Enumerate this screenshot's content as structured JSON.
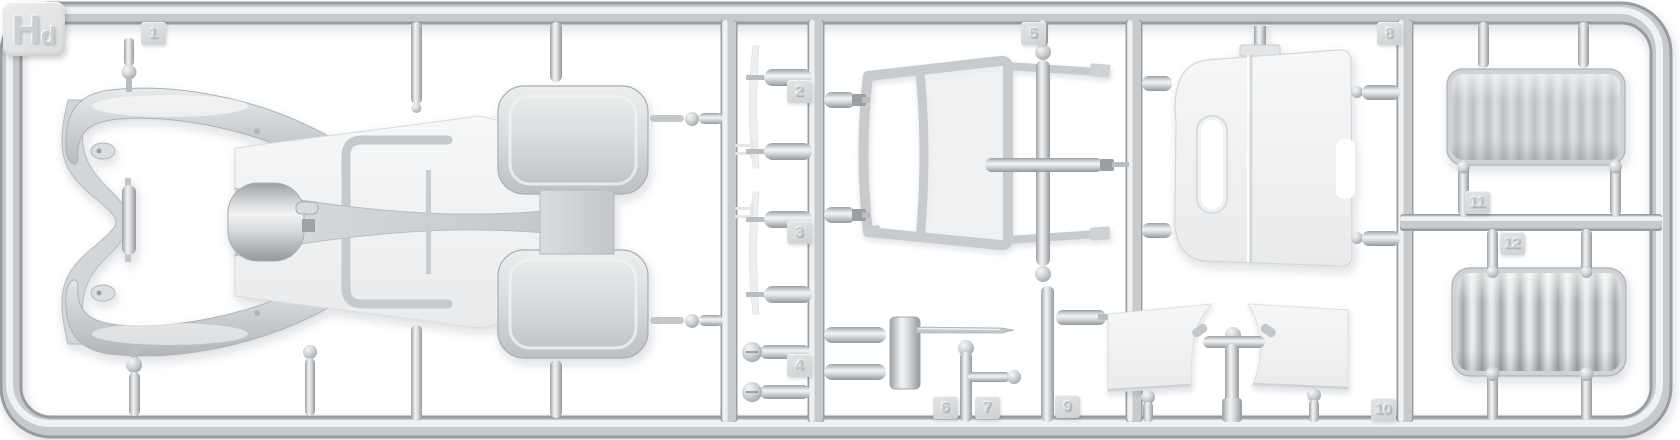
{
  "scene": {
    "subject": "top-view photo of a light-gray injection-molded plastic model kit sprue (runner frame) holding car body parts, windshield frame, roof panel, trim strips, levers and two pleated seat cushions",
    "sprue_label": {
      "full": "Hd",
      "main": "H",
      "sub": "d"
    },
    "part_tags": [
      {
        "label": "1"
      },
      {
        "label": "2"
      },
      {
        "label": "3"
      },
      {
        "label": "4"
      },
      {
        "label": "5"
      },
      {
        "label": "6"
      },
      {
        "label": "7"
      },
      {
        "label": "8"
      },
      {
        "label": "9"
      },
      {
        "label": "10"
      },
      {
        "label": "11"
      },
      {
        "label": "12"
      }
    ],
    "colors": {
      "background": "#ffffff",
      "runner_mid": "#c8cbcd",
      "runner_highlight": "#f0f1f2",
      "runner_shadow": "#989c9f",
      "part_white": "#f2f3f4",
      "part_gray": "#ccd0d3",
      "tag_face": "#d7d9db",
      "embossed_number": "#c6c9cb"
    }
  }
}
